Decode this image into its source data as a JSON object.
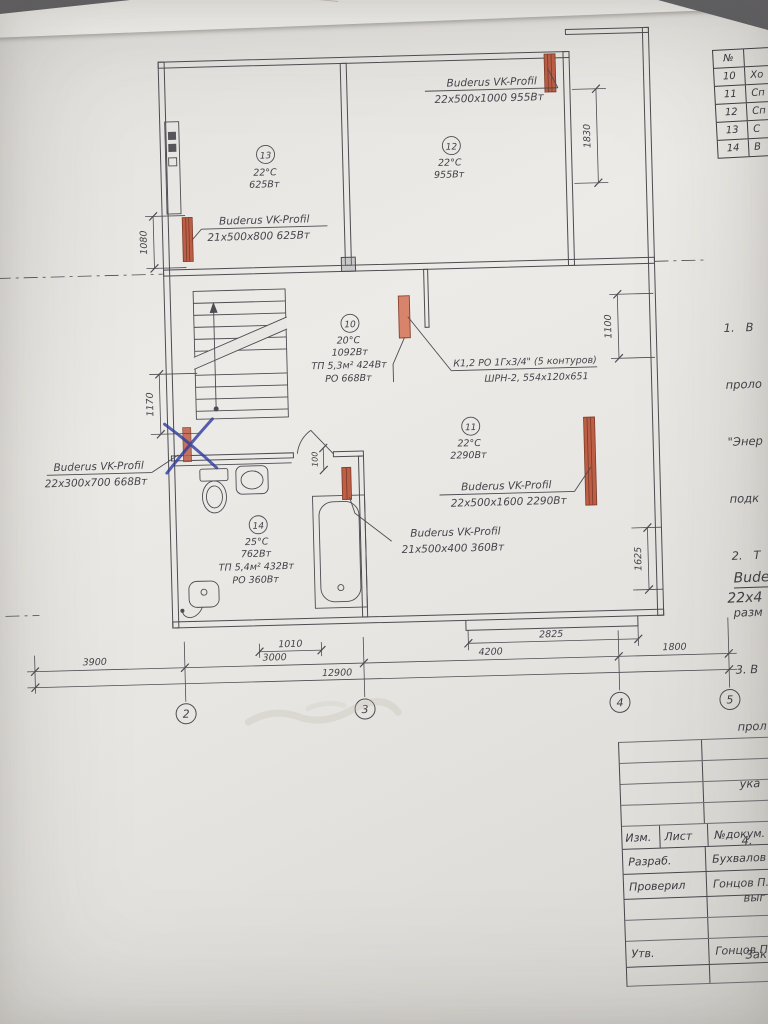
{
  "colors": {
    "radiator_fill": "#bc5f46",
    "radiator_edge": "#7d3a28",
    "pen_mark": "#2e3d9e",
    "drawing_line": "#4c4c52",
    "paper": "#e9e7e3"
  },
  "labels": {
    "rad_top": {
      "l1": "Buderus VK-Profil",
      "l2": "22х500х1000 955Вт"
    },
    "rad_left": {
      "l1": "Buderus VK-Profil",
      "l2": "21х500х800 625Вт"
    },
    "rad_right": {
      "l1": "Buderus VK-Profil",
      "l2": "22х500х1600 2290Вт"
    },
    "rad_bath": {
      "l1": "Buderus VK-Profil",
      "l2": "21х500х400 360Вт"
    },
    "rad_wc": {
      "l1": "Buderus VK-Profil",
      "l2": "22х300х700 668Вт"
    },
    "manifold": {
      "l1": "К1,2 РО 1Гх3/4\" (5 контуров)",
      "l2": "ШРН-2, 554х120х651"
    }
  },
  "rooms": {
    "r10": {
      "num": "10",
      "temp": "20°C",
      "power": "1092Вт",
      "tp": "ТП 5,3м² 424Вт",
      "ro": "РО 668Вт"
    },
    "r11": {
      "num": "11",
      "temp": "22°C",
      "power": "2290Вт"
    },
    "r12": {
      "num": "12",
      "temp": "22°C",
      "power": "955Вт"
    },
    "r13": {
      "num": "13",
      "temp": "22°C",
      "power": "625Вт"
    },
    "r14": {
      "num": "14",
      "temp": "25°C",
      "power": "762Вт",
      "tp": "ТП 5,4м² 432Вт",
      "ro": "РО 360Вт"
    }
  },
  "dims": {
    "b3900": "3900",
    "b3000": "3000",
    "b4200": "4200",
    "b1800": "1800",
    "b12900": "12900",
    "b1010": "1010",
    "b2825": "2825",
    "v1080": "1080",
    "v1170": "1170",
    "v1830": "1830",
    "v1100": "1100",
    "v1625": "1625",
    "v100": "100"
  },
  "axes": {
    "a2": "2",
    "a3": "3",
    "a4": "4",
    "a5": "5"
  },
  "room_table": {
    "no_header": "№",
    "rows": [
      {
        "no": "10",
        "name": "Хо"
      },
      {
        "no": "11",
        "name": "Сп"
      },
      {
        "no": "12",
        "name": "Сп"
      },
      {
        "no": "13",
        "name": "С"
      },
      {
        "no": "14",
        "name": "В"
      }
    ]
  },
  "notes": {
    "lines": [
      "1.   В",
      "проло",
      "\"Энер",
      "подк",
      "2.   Т",
      "разм",
      "3. В",
      "прол",
      "ука",
      "4.",
      "выг",
      "Зак"
    ]
  },
  "side_label": {
    "l1": "Bude",
    "l2": "22х4"
  },
  "title_block": {
    "izm": "Изм.",
    "list": "Лист",
    "doc": "№докум.",
    "razrab": "Разраб.",
    "razrab_name": "Бухвалов С",
    "proveril": "Проверил",
    "proveril_name": "Гонцов П.",
    "utv": "Утв.",
    "utv_name": "Гонцов П."
  }
}
